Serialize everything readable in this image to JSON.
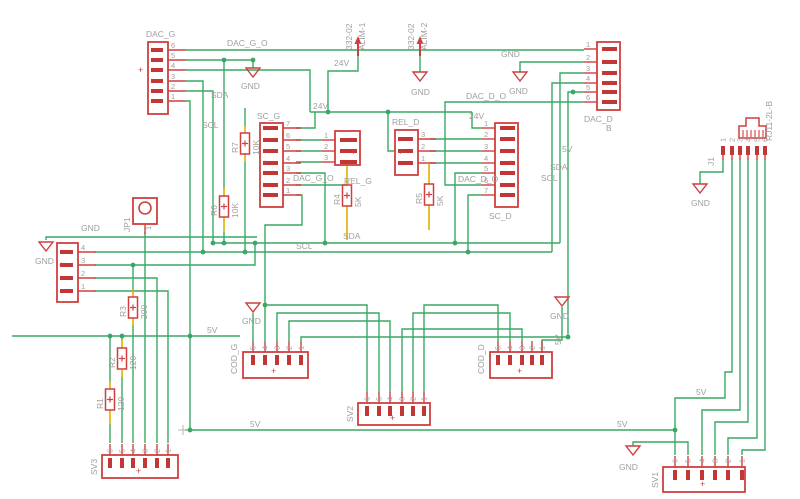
{
  "app": {
    "name": "schematic-canvas"
  },
  "colors": {
    "wire_green": "#3aa864",
    "lead_yellow": "#dfaf00",
    "symbol_red": "#cf3f3f",
    "pad_red": "#c23636",
    "text_gray": "#9e9e9e",
    "background": "#ffffff"
  },
  "net_labels": {
    "sda": "SDA",
    "scl": "SCL",
    "v24": "24V",
    "v5": "5V",
    "gnd": "GND",
    "dac_g_o": "DAC_G_O",
    "dac_d_o": "DAC_D_O"
  },
  "symbols": {
    "plus": "+"
  },
  "connectors": {
    "dac_g": {
      "label": "DAC_G",
      "pins": [
        "6",
        "5",
        "4",
        "3",
        "2",
        "1"
      ]
    },
    "sc_g": {
      "label": "SC_G",
      "pins": [
        "7",
        "6",
        "5",
        "4",
        "3",
        "2",
        "1"
      ]
    },
    "rel_g": {
      "label": "REL_G",
      "pins": [
        "1",
        "2",
        "3"
      ]
    },
    "rel_d": {
      "label": "REL_D",
      "pins": [
        "3",
        "2",
        "1"
      ]
    },
    "sc_d": {
      "label": "SC_D",
      "pins": [
        "1",
        "2",
        "3",
        "4",
        "5",
        "6",
        "7"
      ]
    },
    "dac_d": {
      "label": "DAC_D",
      "value": "B",
      "pins": [
        "1",
        "2",
        "3",
        "4",
        "5",
        "6"
      ]
    },
    "x1": {
      "label": "",
      "pins": [
        "4",
        "3",
        "2",
        "1"
      ]
    },
    "jp1": {
      "label": "JP1",
      "pins": [
        "1"
      ]
    },
    "j1": {
      "label": "J1",
      "value": "RJ11-2L-B",
      "pins": [
        "1",
        "2",
        "3",
        "4",
        "5",
        "6"
      ]
    },
    "cod_g": {
      "label": "COD_G",
      "pins": [
        "5",
        "4",
        "3",
        "2",
        "1"
      ]
    },
    "cod_d": {
      "label": "COD_D",
      "pins": [
        "5",
        "4",
        "3",
        "2",
        "1"
      ]
    },
    "sv1": {
      "label": "SV1",
      "pins": [
        "6",
        "5",
        "4",
        "3",
        "2",
        "1"
      ]
    },
    "sv2": {
      "label": "SV2",
      "pins": [
        "6",
        "5",
        "4",
        "3",
        "2",
        "1"
      ]
    },
    "sv3": {
      "label": "SV3",
      "pins": [
        "6",
        "5",
        "4",
        "3",
        "2",
        "1"
      ]
    },
    "alim1": {
      "label": "ALIM-1",
      "value": "332-02"
    },
    "alim2": {
      "label": "ALIM-2",
      "value": "332-02"
    }
  },
  "resistors": {
    "r7": {
      "label": "R7",
      "value": "10K"
    },
    "r6": {
      "label": "R6",
      "value": "10K"
    },
    "r4": {
      "label": "R4",
      "value": "5K"
    },
    "r5": {
      "label": "R5",
      "value": "5K"
    },
    "r3": {
      "label": "R3",
      "value": "200"
    },
    "r2": {
      "label": "R2",
      "value": "120"
    },
    "r1": {
      "label": "R1",
      "value": "120"
    }
  }
}
